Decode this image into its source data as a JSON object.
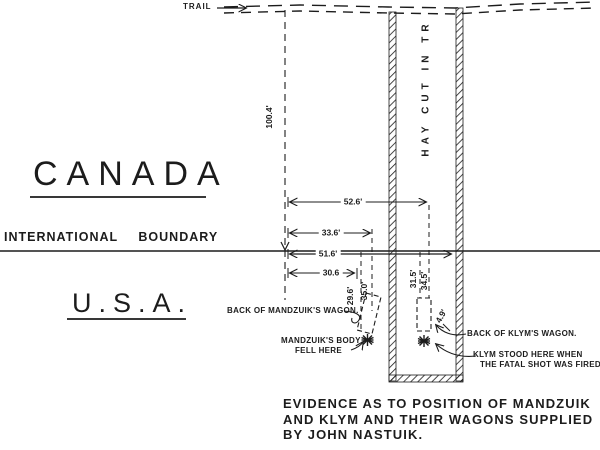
{
  "labels": {
    "trail": "TRAIL",
    "hay_cut": "HAY CUT IN TR",
    "canada": "CANADA",
    "international_boundary": "INTERNATIONAL BOUNDARY",
    "usa": "U.S.A."
  },
  "measurements": {
    "trail_to_boundary": "100.4'",
    "ref_to_klym_wagon": "52.6'",
    "ref_to_mandzuik_far": "33.6'",
    "ref_along_boundary": "51.6'",
    "ref_to_mandzuik_near": "30.6",
    "mandzuik_near_depth": "29.6'",
    "mandzuik_far_depth": "35.0'",
    "klym_near_depth": "31.5'",
    "klym_far_depth": "34.5'",
    "klym_offset": "4.9'"
  },
  "annotations": {
    "mandzuik_wagon": "BACK OF MANDZUIK'S WAGON.",
    "mandzuik_body_line1": "MANDZUIK'S BODY",
    "mandzuik_body_line2": "FELL HERE",
    "klym_wagon": "BACK OF KLYM'S WAGON.",
    "klym_position_line1": "KLYM STOOD HERE WHEN",
    "klym_position_line2": "THE FATAL SHOT WAS FIRED."
  },
  "caption": {
    "line1": "EVIDENCE AS TO POSITION OF MANDZUIK",
    "line2": "AND KLYM AND THEIR WAGONS SUPPLIED",
    "line3": "BY JOHN NASTUIK."
  },
  "colors": {
    "ink": "#1c1c1c",
    "paper": "#ffffff"
  }
}
